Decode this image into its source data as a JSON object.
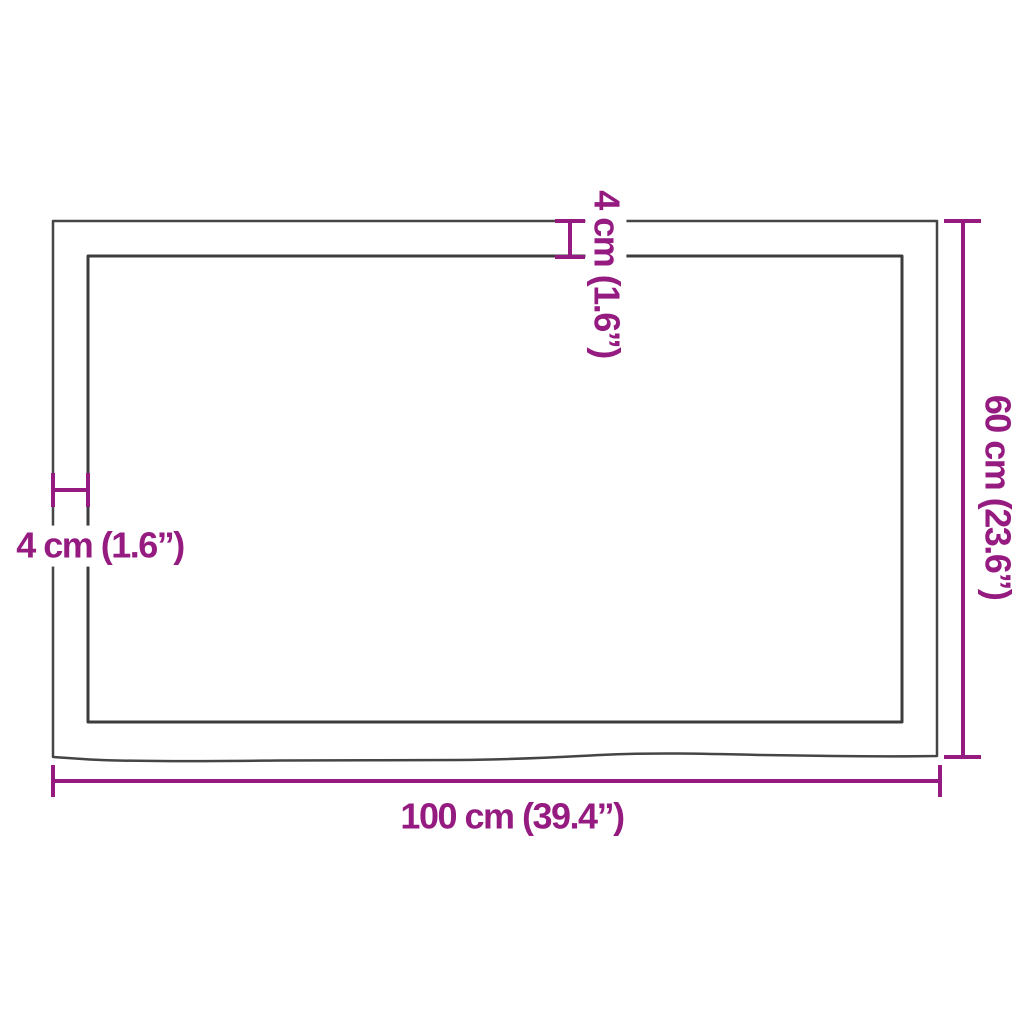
{
  "diagram": {
    "kind": "product-dimension-diagram",
    "dimensions": {
      "width_label": "100 cm (39.4”)",
      "height_label": "60 cm (23.6”)",
      "thickness_top_label": "4 cm (1.6”)",
      "edge_left_label": "4 cm (1.6”)"
    },
    "colors": {
      "dimension_accent": "#951B81",
      "outline_dark": "#454545",
      "background": "#FFFFFF"
    }
  }
}
